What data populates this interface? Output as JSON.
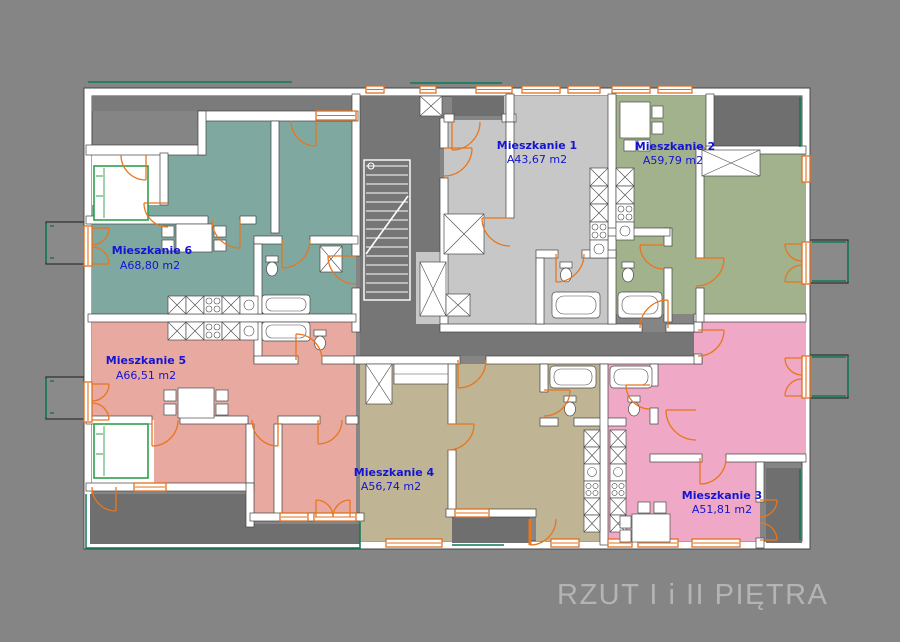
{
  "title": "RZUT I i II PIĘTRA",
  "apartments": [
    {
      "id": "1",
      "name": "Mieszkanie 1",
      "area": "A43,67 m2",
      "color": "#c7c7c7"
    },
    {
      "id": "2",
      "name": "Mieszkanie 2",
      "area": "A59,79 m2",
      "color": "#a2b28d"
    },
    {
      "id": "3",
      "name": "Mieszkanie 3",
      "area": "A51,81 m2",
      "color": "#efa9c6"
    },
    {
      "id": "4",
      "name": "Mieszkanie 4",
      "area": "A56,74 m2",
      "color": "#bfb493"
    },
    {
      "id": "5",
      "name": "Mieszkanie 5",
      "area": "A66,51 m2",
      "color": "#e8a9a1"
    },
    {
      "id": "6",
      "name": "Mieszkanie 6",
      "area": "A68,80 m2",
      "color": "#7fa8a1"
    }
  ],
  "colors": {
    "background": "#858585",
    "corridor_gray": "#767676",
    "wall_white": "#ffffff",
    "wall_line": "#424242",
    "door_orange": "#e8761e",
    "railing_green": "#0c7a58",
    "bed_green": "#2e9e4d",
    "label_blue": "#1414d2",
    "title_gray": "#b4b4b4"
  }
}
